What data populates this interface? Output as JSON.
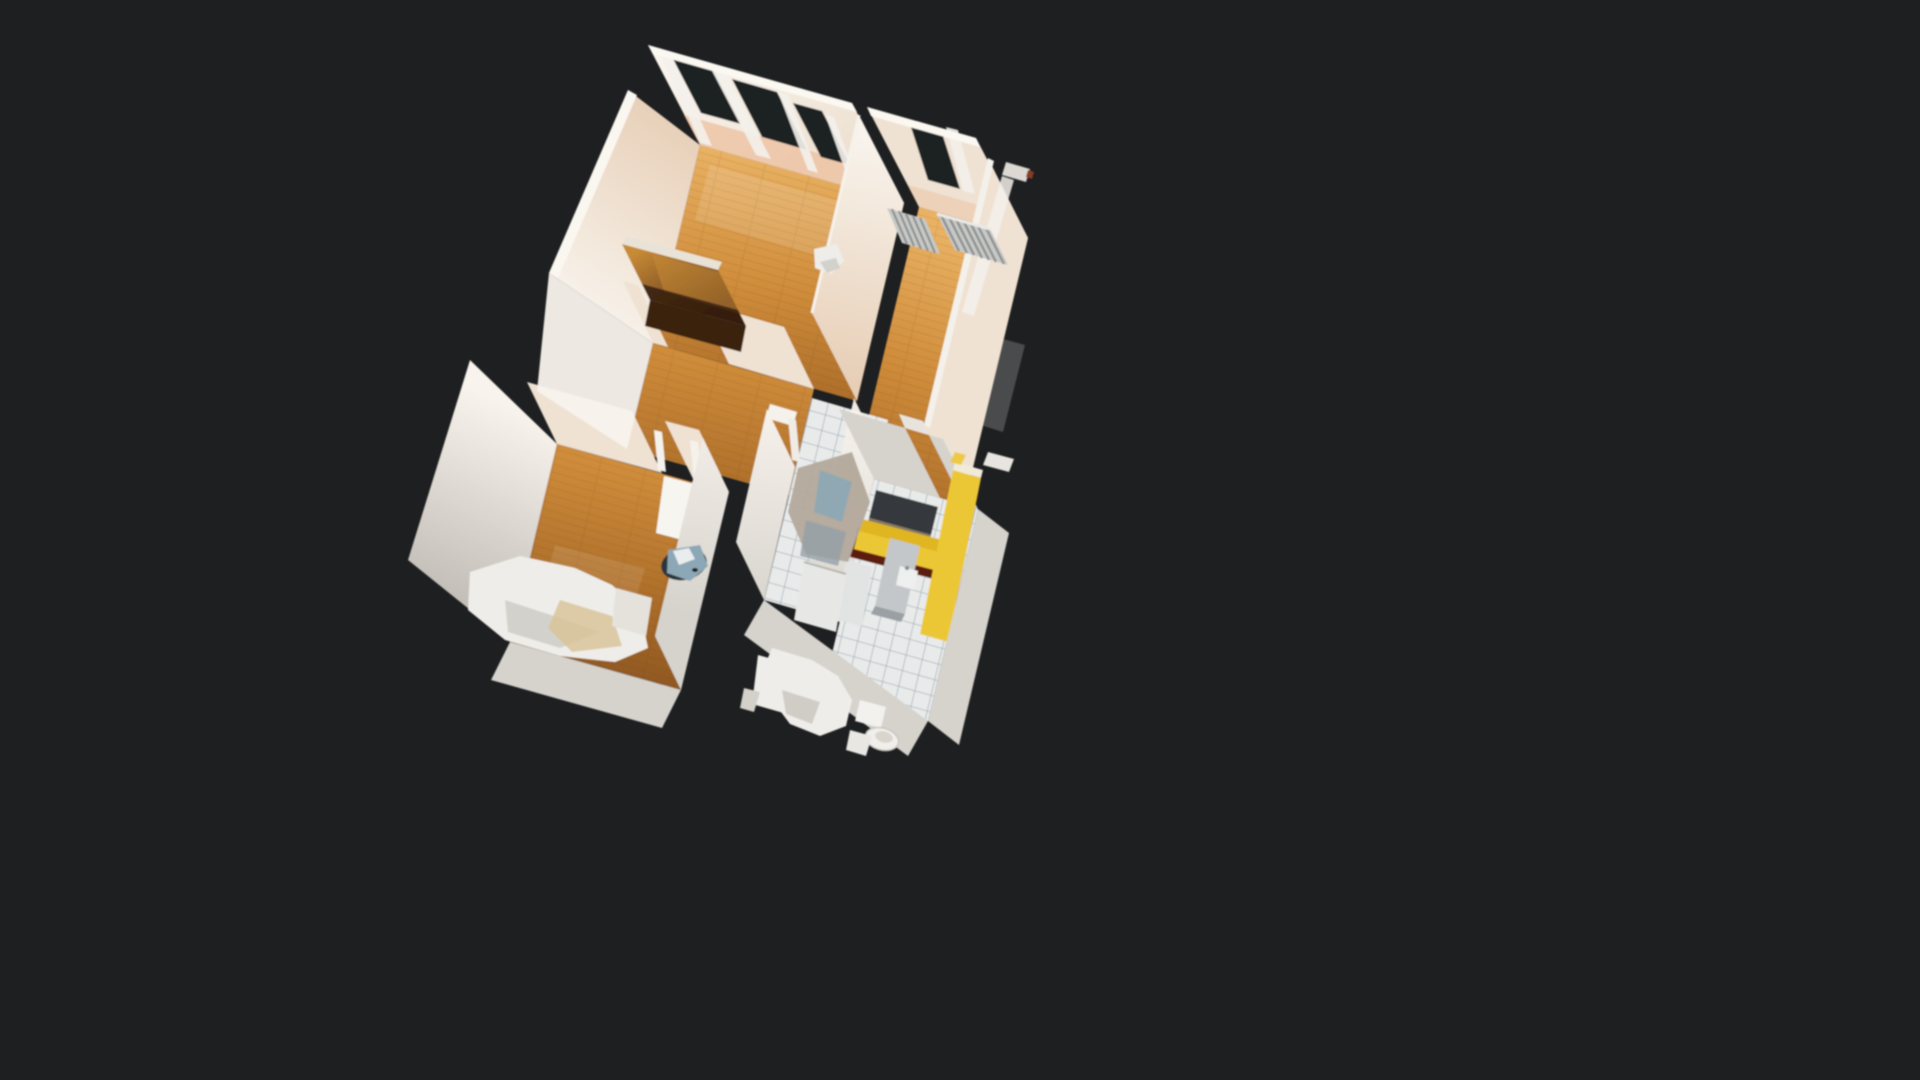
{
  "app": {
    "name": "3D property tour viewer",
    "view_mode": "dollhouse",
    "background": "#1d1f21"
  },
  "scene": {
    "description": "Top-down oblique 3D dollhouse scan of a small apartment floating on a dark background",
    "rooms": [
      {
        "name": "bedroom-upper-left",
        "floor": "hardwood"
      },
      {
        "name": "living-room-right",
        "floor": "hardwood"
      },
      {
        "name": "hallway",
        "floor": "hardwood"
      },
      {
        "name": "bedroom-lower-left",
        "floor": "hardwood"
      },
      {
        "name": "bathroom-center",
        "floor": "white-tile"
      },
      {
        "name": "kitchen-lower-right",
        "floor": "white-tile"
      }
    ],
    "objects": [
      "window-openings-with-curtains",
      "radiators",
      "wardrobe-with-gold-mirror",
      "open-door",
      "toilet",
      "bathroom-fixtures",
      "yellow-kitchen-counter",
      "dark-countertop",
      "refrigerator",
      "floor-scan-holes",
      "laundry-bedding-pile"
    ]
  },
  "colors": {
    "background": "#1d1f21",
    "opening_dark": "#1e2023",
    "wood_light": "#e9b264",
    "wood_mid": "#cf8c3a",
    "wood_dark": "#a96b28",
    "wood_deep": "#8a5420",
    "wall_bright": "#f8f3ec",
    "wall_cream": "#efe2d3",
    "wall_warm": "#e6cdb4",
    "wall_pink": "#ecbf9d",
    "wall_grey": "#d6d3cd",
    "wall_grey_dark": "#b7b3ac",
    "tile_light": "#e9ebeb",
    "grout": "#9aa5ad",
    "kitchen_yellow": "#ecc734",
    "kitchen_gold": "#d9a916",
    "kitchen_maroon": "#5d1a0b",
    "counter_dark": "#35393e",
    "radiator_grey": "#c7c9c7",
    "radiator_dark": "#8e918f",
    "wardrobe_brown": "#56321b",
    "wardrobe_dark": "#2e1a0d",
    "wardrobe_gold": "#c78a35",
    "artifact_blue": "#8ca7b5",
    "blob_white": "#efede9",
    "blob_shadow": "#c8c4bd",
    "blob_tan": "#d8c49a",
    "curtain_white": "#f3f0ea",
    "fixture_tan": "#b3a99b",
    "fixture_grey": "#95a0a7",
    "steel_grey": "#c3c7c9"
  }
}
